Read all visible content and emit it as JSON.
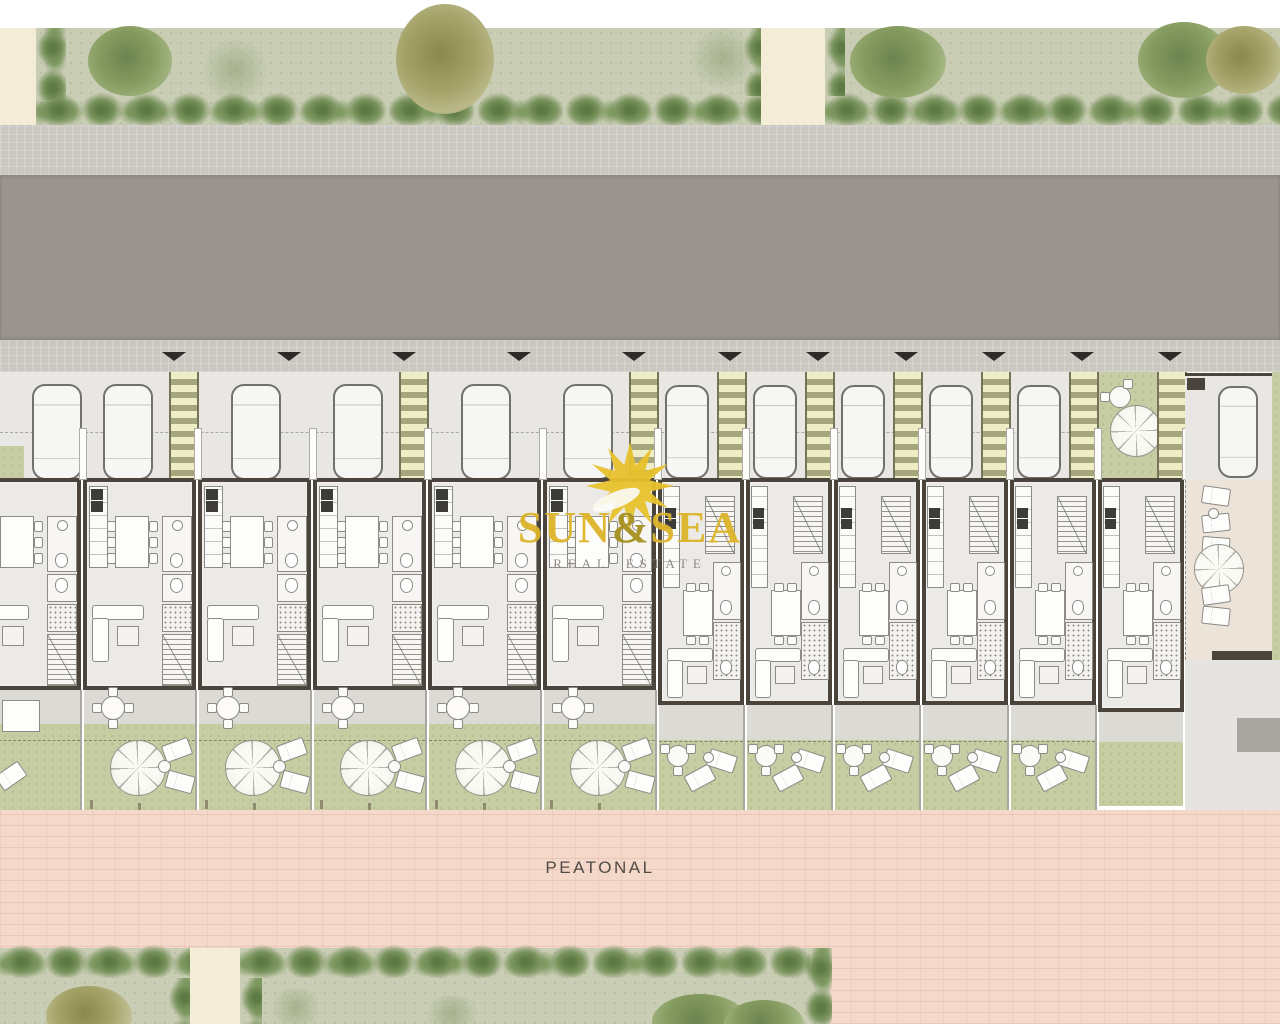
{
  "brand": {
    "sun": "SUN",
    "ampersand": "&",
    "sea": "SEA",
    "subtitle": "REAL ESTATE"
  },
  "labels": {
    "pedestrian_street": "PEATONAL"
  },
  "site": {
    "unit_count": 12,
    "units": [
      {
        "id": 1,
        "type": "A"
      },
      {
        "id": 2,
        "type": "A"
      },
      {
        "id": 3,
        "type": "A"
      },
      {
        "id": 4,
        "type": "A"
      },
      {
        "id": 5,
        "type": "A"
      },
      {
        "id": 6,
        "type": "A"
      },
      {
        "id": 7,
        "type": "B"
      },
      {
        "id": 8,
        "type": "B"
      },
      {
        "id": 9,
        "type": "B"
      },
      {
        "id": 10,
        "type": "B"
      },
      {
        "id": 11,
        "type": "B"
      },
      {
        "id": 12,
        "type": "C"
      }
    ]
  },
  "colors": {
    "brand_gold": "#ddb52a",
    "subtitle_gray": "#8b867c",
    "label_text": "#504b45",
    "road": "#9b948e",
    "sidewalk": "#cbc7c1",
    "parking": "#e8e7e4",
    "floor": "#eceae6",
    "wall": "#4b443d",
    "pergola": "#a5a67b",
    "pergola_slat": "#eeedc6",
    "lawn": "#c7cda3",
    "terrace": "#dcdad5",
    "park": "#c8cdb4",
    "hedge": "#77915a",
    "cream": "#f3ecd7",
    "pink_paving": "#f4d8ca",
    "patio": "#ece4d8"
  }
}
